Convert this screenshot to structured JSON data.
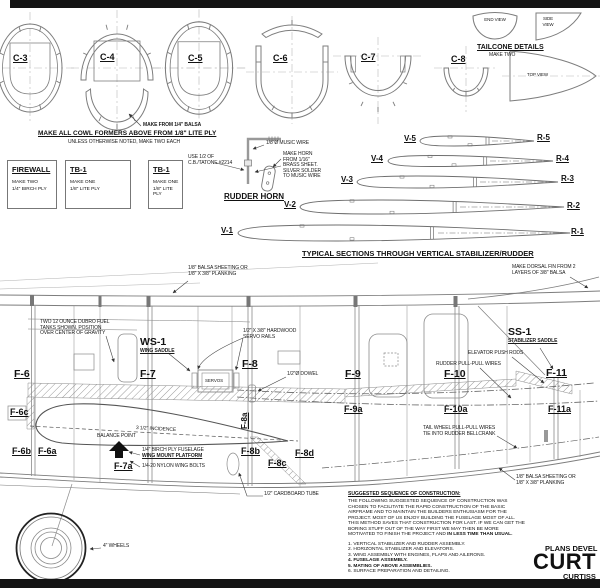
{
  "cowl": {
    "former_labels": [
      "C-3",
      "C-4",
      "C-5",
      "C-6",
      "C-7",
      "C-8"
    ],
    "balsa_note": "MAKE FROM 1/4\" BALSA",
    "main_note": "MAKE ALL COWL FORMERS ABOVE FROM 1/8\" LITE PLY",
    "sub_note": "UNLESS OTHERWISE NOTED, MAKE TWO EACH"
  },
  "tailcone": {
    "title": "TAILCONE DETAILS",
    "sub": "MAKE TWO",
    "end_view": "END VIEW",
    "side_view": "SIDE VIEW",
    "top_view": "TOP VIEW"
  },
  "part_boxes": [
    {
      "title": "FIREWALL",
      "line1": "MAKE TWO",
      "line2": "1/4\" BIRCH PLY"
    },
    {
      "title": "TB-1",
      "line1": "MAKE ONE",
      "line2": "1/8\" LITE PLY"
    },
    {
      "title": "TB-1",
      "line1": "MAKE ONE",
      "line2": "1/8\" LITE PLY"
    }
  ],
  "rudder_horn": {
    "title": "RUDDER HORN",
    "tatone_note": "USE 1/2 OF C.B./TATONE #2214",
    "wire_note": "1/8\"Ø MUSIC WIRE",
    "horn_note": "MAKE HORN FROM 1/16\" BRASS SHEET. SILVER SOLDER TO MUSIC WIRE"
  },
  "stab_sections": {
    "title": "TYPICAL SECTIONS THROUGH VERTICAL STABILIZER/RUDDER",
    "rows": [
      {
        "left": "V-5",
        "right": "R-5"
      },
      {
        "left": "V-4",
        "right": "R-4"
      },
      {
        "left": "V-3",
        "right": "R-3"
      },
      {
        "left": "V-2",
        "right": "R-2"
      },
      {
        "left": "V-1",
        "right": "R-1"
      }
    ]
  },
  "fuselage": {
    "formers": {
      "f6": "F-6",
      "f6a": "F-6a",
      "f6b": "F-6b",
      "f6c": "F-6c",
      "f7": "F-7",
      "f7a": "F-7a",
      "f8": "F-8",
      "f8a": "F-8a",
      "f8b": "F-8b",
      "f8c": "F-8c",
      "f8d": "F-8d",
      "f9": "F-9",
      "f9a": "F-9a",
      "f10": "F-10",
      "f10a": "F-10a",
      "f11": "F-11",
      "f11a": "F-11a"
    },
    "ws1": "WS-1",
    "ws1_sub": "WING SADDLE",
    "ss1": "SS-1",
    "ss1_sub": "STABILIZER SADDLE",
    "servos": "SERVOS",
    "balance": "BALANCE POINT",
    "incidence": "3 1/2\" INCIDENCE",
    "notes": {
      "sheeting": "1/8\" BALSA SHEETING OR 1/8\" X 3/8\" PLANKING",
      "fuel": "TWO 12 OUNCE DUBRO FUEL TANKS SHOWN. POSITION OVER CENTER OF GRAVITY",
      "servo_rails": "1/2\" X 3/8\" HARDWOOD SERVO RAILS",
      "dowel": "1/2\"Ø DOWEL",
      "dorsal": "MAKE DORSAL FIN FROM 2 LAYERS OF 3/8\" BALSA",
      "elevator": "ELEVATOR PUSH RODS",
      "rudder_wires": "RUDDER PULL-PULL WIRES",
      "tailwheel": "TAIL WHEEL PULL-PULL WIRES TIE INTO RUDDER BELLCRANK",
      "platform1": "1/4\" BIRCH PLY FUSELAGE",
      "platform2": "WING MOUNT PLATFORM",
      "bolts": "1/4-20 NYLON WING BOLTS",
      "tube": "1/2\" CARDBOARD TUBE",
      "wheels": "4\" WHEELS"
    }
  },
  "sequence": {
    "heading": "SUGGESTED SEQUENCE OF CONSTRUCTION:",
    "body": "THE FOLLOWING SUGGESTED SEQUENCE OF CONSTRUCTION WAS CHOSEN TO FACILITATE THE RAPID CONSTRUCTION OF THE BASIC AIRFRAME AND TO MAINTAIN THE BUILDERS ENTHUSIASM FOR THE PROJECT. MOST OF US ENJOY BUILDING THE FUSELAGE MOST OF ALL. THIS METHOD SAVES THAT CONSTRUCTION FOR LAST. IF WE CAN GET THE BORING STUFF OUT OF THE WAY FIRST WE MAY THEN BE MORE MOTIVATED TO FINISH THE PROJECT AND ",
    "body_bold": "IN LESS TIME THAN USUAL.",
    "items": [
      "1. VERTICAL STABILIZER AND RUDDER ASSEMBLY.",
      "2. HORIZONTAL STABILIZER AND ELEVATORS.",
      "3. WING ASSEMBLY WITH ENGINES, FLAPS AND AILERONS.",
      "4. FUSELAGE ASSEMBLY.",
      "5. MATING OF ABOVE ASSEMBLIES.",
      "6. SURFACE PREPARATION AND DETAILING."
    ]
  },
  "title_block": {
    "pre": "PLANS DEVEL",
    "main": "CURT",
    "sub": "CURTISS"
  }
}
